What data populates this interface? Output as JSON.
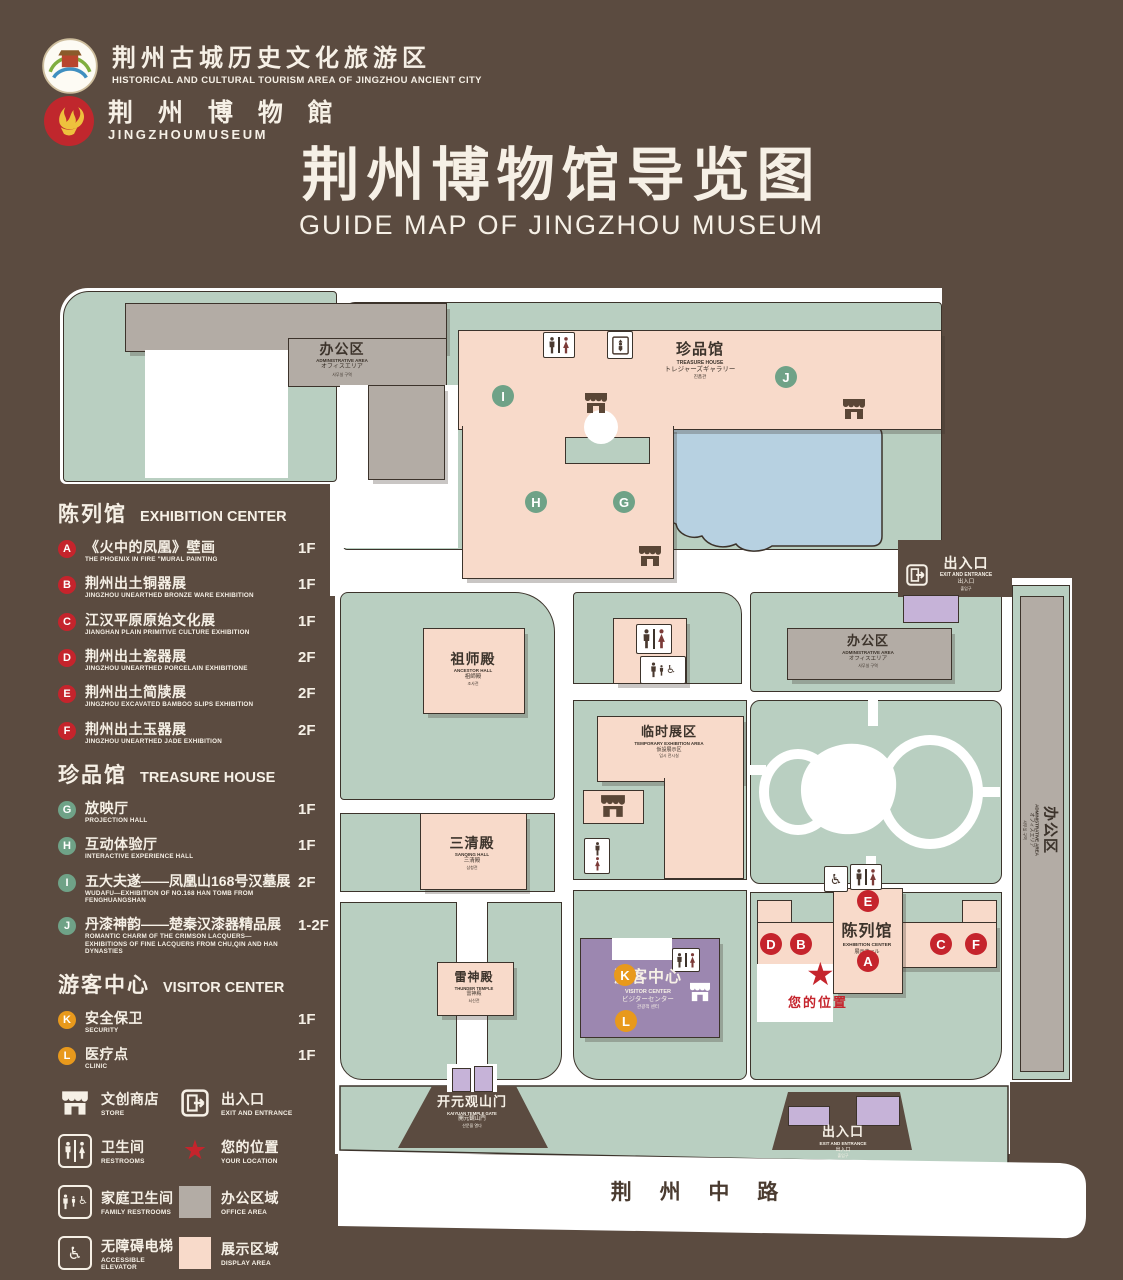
{
  "colors": {
    "bg": "#5b4b40",
    "map_green": "#b9cfc1",
    "bldg_pink": "#f8daca",
    "bldg_gray": "#b3aca5",
    "purple": "#9c87b0",
    "gate_purple": "#c6b3d8",
    "pond_blue": "#b7d1e1",
    "marker_red": "#c5242c",
    "marker_green": "#6fa287",
    "marker_orange": "#e8991c",
    "text_cream": "#f6f0e6",
    "outline": "#3c332b"
  },
  "header": {
    "tourism_logo": {
      "title": "荆州古城历史文化旅游区",
      "subtitle": "HISTORICAL AND CULTURAL TOURISM AREA OF JINGZHOU ANCIENT CITY"
    },
    "museum_logo": {
      "title": "荆 州 博 物 館",
      "subtitle": "JINGZHOUMUSEUM"
    },
    "title": "荆州博物馆导览图",
    "subtitle": "GUIDE MAP OF JINGZHOU MUSEUM"
  },
  "legend": {
    "sections": [
      {
        "title_zh": "陈列馆",
        "title_en": "EXHIBITION CENTER",
        "items": [
          {
            "key": "A",
            "zh": "《火中的凤凰》壁画",
            "en": "THE PHOENIX IN FIRE \"MURAL PAINTING",
            "floor": "1F"
          },
          {
            "key": "B",
            "zh": "荆州出土铜器展",
            "en": "JINGZHOU UNEARTHED BRONZE WARE EXHIBITION",
            "floor": "1F"
          },
          {
            "key": "C",
            "zh": "江汉平原原始文化展",
            "en": "JIANGHAN PLAIN PRIMITIVE CULTURE EXHIBITION",
            "floor": "1F"
          },
          {
            "key": "D",
            "zh": "荆州出土瓷器展",
            "en": "JINGZHOU UNEARTHED PORCELAIN EXHIBITIONE",
            "floor": "2F"
          },
          {
            "key": "E",
            "zh": "荆州出土简牍展",
            "en": "JINGZHOU EXCAVATED BAMBOO SLIPS EXHIBITION",
            "floor": "2F"
          },
          {
            "key": "F",
            "zh": "荆州出土玉器展",
            "en": "JINGZHOU UNEARTHED JADE EXHIBITION",
            "floor": "2F"
          }
        ]
      },
      {
        "title_zh": "珍品馆",
        "title_en": "TREASURE HOUSE",
        "items": [
          {
            "key": "G",
            "zh": "放映厅",
            "en": "PROJECTION HALL",
            "floor": "1F"
          },
          {
            "key": "H",
            "zh": "互动体验厅",
            "en": "INTERACTIVE EXPERIENCE HALL",
            "floor": "1F"
          },
          {
            "key": "I",
            "zh": "五大夫遂——凤凰山168号汉墓展",
            "en": "WUDAFU—EXHIBITION OF NO.168 HAN TOMB FROM FENGHUANGSHAN",
            "floor": "2F"
          },
          {
            "key": "J",
            "zh": "丹漆神韵——楚秦汉漆器精品展",
            "en": "ROMANTIC CHARM OF THE CRIMSON LACQUERS—EXHIBITIONS OF FINE LACQUERS FROM CHU,QIN AND HAN DYNASTIES",
            "floor": "1-2F"
          }
        ]
      },
      {
        "title_zh": "游客中心",
        "title_en": "VISITOR CENTER",
        "items": [
          {
            "key": "K",
            "zh": "安全保卫",
            "en": "SECURITY",
            "floor": "1F"
          },
          {
            "key": "L",
            "zh": "医疗点",
            "en": "CLINIC",
            "floor": "1F"
          }
        ]
      }
    ],
    "facilities": [
      {
        "zh": "文创商店",
        "en": "STORE"
      },
      {
        "zh": "出入口",
        "en": "EXIT AND ENTRANCE"
      },
      {
        "zh": "卫生间",
        "en": "RESTROOMS"
      },
      {
        "zh": "您的位置",
        "en": "YOUR LOCATION"
      },
      {
        "zh": "家庭卫生间",
        "en": "FAMILY RESTROOMS"
      },
      {
        "zh": "办公区域",
        "en": "OFFICE AREA"
      },
      {
        "zh": "无障碍电梯",
        "en": "ACCESSIBLE ELEVATOR"
      },
      {
        "zh": "展示区域",
        "en": "DISPLAY AREA"
      },
      {
        "zh": "电梯",
        "en": "Elevator"
      }
    ]
  },
  "map": {
    "admin": {
      "zh": "办公区",
      "en": "ADMINISTRATIVE AREA",
      "ja": "オフィスエリア",
      "ko": "사무실 구역"
    },
    "treasure": {
      "zh": "珍品馆",
      "en": "TREASURE HOUSE",
      "ja": "トレジャーズギャラリー",
      "ko": "진품관"
    },
    "ancestor": {
      "zh": "祖师殿",
      "en": "ANCESTOR HALL",
      "ja": "祖師殿",
      "ko": "조사전"
    },
    "sanqing": {
      "zh": "三清殿",
      "en": "SANQING HALL",
      "ja": "三清殿",
      "ko": "삼청전"
    },
    "thunder": {
      "zh": "雷神殿",
      "en": "THUNDER TEMPLE",
      "ja": "雷神殿",
      "ko": "뇌신전"
    },
    "temporary": {
      "zh": "临时展区",
      "en": "TEMPORARY EXHIBITION AREA",
      "ja": "仮設展示区",
      "ko": "임시 전시실"
    },
    "exhibition": {
      "zh": "陈列馆",
      "en": "EXHIBITION CENTER",
      "ja": "展示ホール",
      "ko": "진열관"
    },
    "visitor": {
      "zh": "游客中心",
      "en": "VISITOR CENTER",
      "ja": "ビジターセンター",
      "ko": "관광객 센터"
    },
    "exit": {
      "zh": "出入口",
      "en": "EXIT AND ENTRANCE",
      "ja": "出入口",
      "ko": "출입구"
    },
    "gate": {
      "zh": "开元观山门",
      "en": "KAIYUAN TEMPLE GATE",
      "ja": "開元観山門",
      "ko": "산문을 열다"
    },
    "road": "荆 州 中 路",
    "your_location": "您的位置",
    "letters": {
      "a": "A",
      "b": "B",
      "c": "C",
      "d": "D",
      "e": "E",
      "f": "F",
      "g": "G",
      "h": "H",
      "i": "I",
      "j": "J",
      "k": "K",
      "l": "L"
    }
  }
}
